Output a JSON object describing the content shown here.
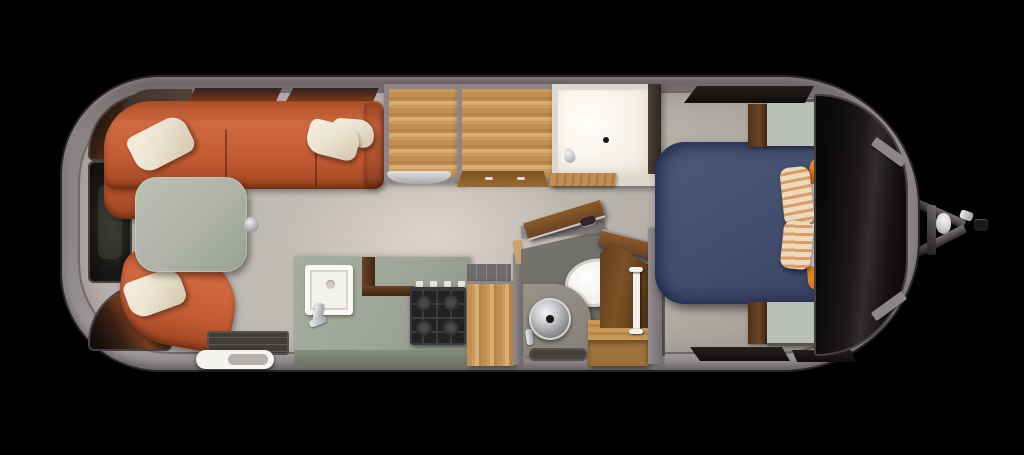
{
  "scene": {
    "kind": "travel-trailer-floor-plan",
    "view": "top-down-3d-render",
    "rooms": [
      {
        "name": "front-lounge",
        "items": [
          "wraparound-sofa",
          "cream-throw-pillows",
          "pedestal-table",
          "lounge-chair",
          "entry-step",
          "entry-mat",
          "side-windows"
        ]
      },
      {
        "name": "galley",
        "items": [
          "refrigerator-with-counter",
          "cabinet-with-counter",
          "kitchen-counter",
          "square-sink",
          "faucet",
          "gas-cooktop",
          "pantry-cabinet",
          "wood-backsplash"
        ]
      },
      {
        "name": "bathroom",
        "items": [
          "shower-stall",
          "shower-head",
          "drain",
          "wood-bath-mat",
          "toilet",
          "round-steel-sink",
          "vanity",
          "wood-step",
          "towel-bar",
          "open-wood-door"
        ]
      },
      {
        "name": "bedroom",
        "items": [
          "double-bed-navy",
          "white-sheet",
          "striped-pillows",
          "orange-band-pillows",
          "nightstand-front",
          "nightstand-rear",
          "wraparound-rear-windows"
        ]
      },
      {
        "name": "exterior",
        "items": [
          "aluminum-shell",
          "a-frame-tongue",
          "coupler",
          "jack-latch"
        ]
      }
    ]
  },
  "colors": {
    "bg": "#000000",
    "shell": "#8b8284",
    "shellEdge": "#292526",
    "floorA": "#c7c1ba",
    "floorB": "#a29b95",
    "bathFloor": "#6e6c66",
    "sofa": "#c05a33",
    "sofaDark": "#9c441f",
    "sofaLight": "#cf6a3f",
    "cushion": "#ece4d2",
    "cushionShade": "#d2c6ab",
    "tableTop": "#aeb2a7",
    "sage": "#b9beb7",
    "oak": "#c99b5e",
    "oakLight": "#d8af74",
    "oakMid": "#c18f4f",
    "oakDark": "#8a5a28",
    "walnut": "#6b4423",
    "walnutDark": "#3f2712",
    "counter": "#9ea495",
    "counterFront": "#78806f",
    "cooktop": "#232122",
    "grate": "#3d3b3c",
    "bed": "#45506f",
    "bedDark": "#222b4e",
    "bedLight": "#4d5878",
    "sheet": "#f3f2ee",
    "orange": "#e0761c",
    "stripeBase": "#ead9bd",
    "stripeOrange": "#dd9a63",
    "glass": "#141113",
    "steel": "#c9cacd",
    "steelDark": "#8e9093",
    "white": "#f6f4f0",
    "matDark": "#403c39",
    "frame": "#8d8587",
    "wallLine": "#564f51"
  }
}
